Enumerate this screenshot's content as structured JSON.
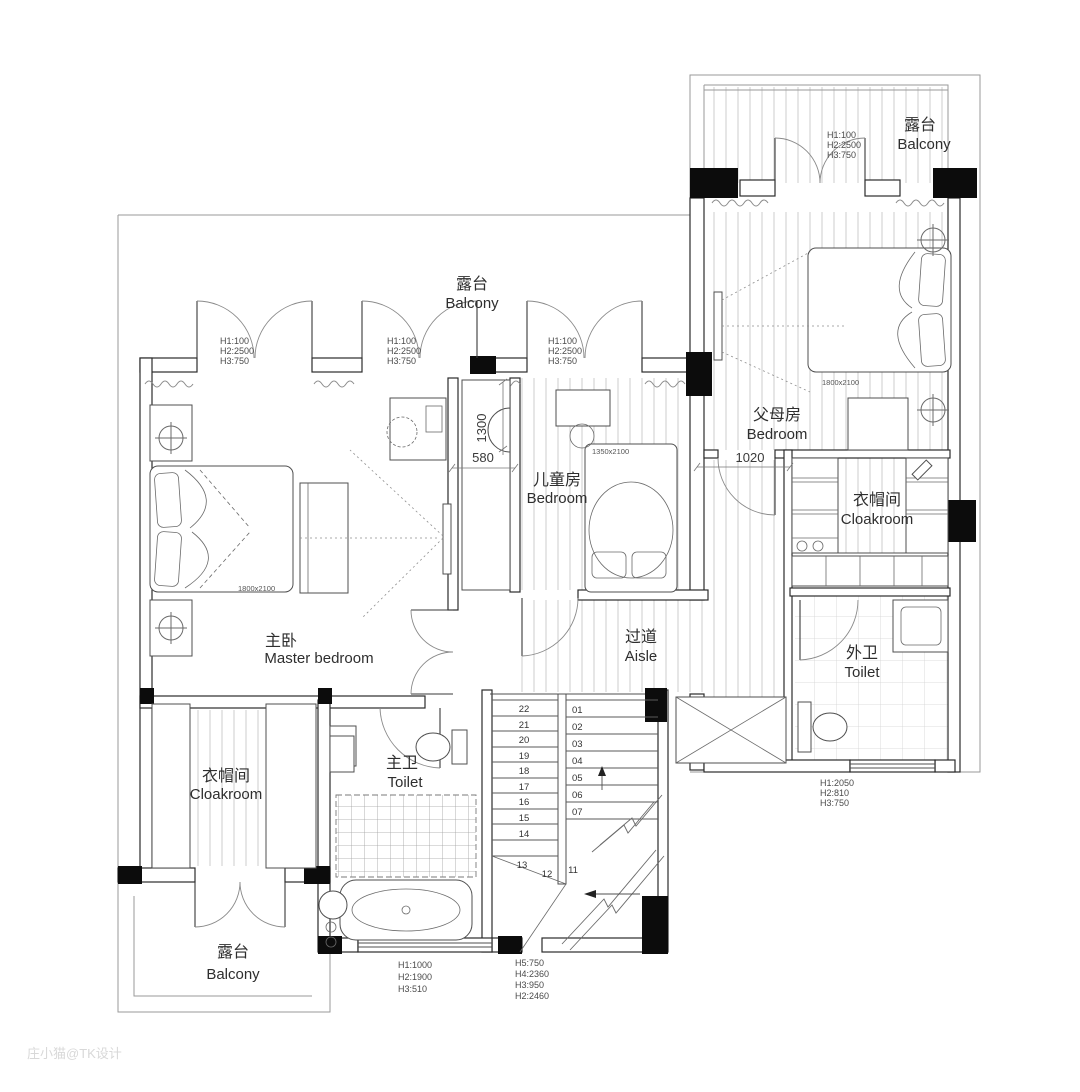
{
  "watermark": "庄小猫@TK设计",
  "colors": {
    "wall": "#2b2b2b",
    "pier": "#0c0c0c",
    "floor_hatch": "#c9c9c9",
    "boundary": "#9a9a9a",
    "watermark": "#d8d8d8"
  },
  "rooms": {
    "balcony_top_right": {
      "zh": "露台",
      "en": "Balcony"
    },
    "balcony_main": {
      "zh": "露台",
      "en": "Balcony"
    },
    "parents_bedroom": {
      "zh": "父母房",
      "en": "Bedroom"
    },
    "kids_bedroom": {
      "zh": "儿童房",
      "en": "Bedroom"
    },
    "cloakroom_right": {
      "zh": "衣帽间",
      "en": "Cloakroom"
    },
    "toilet_outer": {
      "zh": "外卫",
      "en": "Toilet"
    },
    "aisle": {
      "zh": "过道",
      "en": "Aisle"
    },
    "master_bedroom": {
      "zh": "主卧",
      "en": "Master bedroom"
    },
    "cloakroom_left": {
      "zh": "衣帽间",
      "en": "Cloakroom"
    },
    "toilet_master": {
      "zh": "主卫",
      "en": "Toilet"
    },
    "balcony_bottom": {
      "zh": "露台",
      "en": "Balcony"
    }
  },
  "beds": {
    "master": "1800x2100",
    "parents": "1800x2100",
    "kids": "1350x2100"
  },
  "dims": {
    "niche_depth": "1300",
    "niche_width": "580",
    "parents_dim": "1020"
  },
  "door_labels": {
    "balcony_door": {
      "l1": "H1:100",
      "l2": "H2:2500",
      "l3": "H3:750"
    },
    "outer_toilet_window": {
      "l1": "H1:2050",
      "l2": "H2:810",
      "l3": "H3:750"
    },
    "bath_window": {
      "l1": "H1:1000",
      "l2": "H2:1900",
      "l3": "H3:510"
    },
    "stair_window": {
      "l1": "H5:750",
      "l2": "H4:2360",
      "l3": "H3:950",
      "l4": "H2:2460"
    }
  },
  "stairs": {
    "upper_flight": [
      "22",
      "21",
      "20",
      "19",
      "18",
      "17",
      "16",
      "15",
      "14"
    ],
    "turn": [
      "13",
      "12",
      "11"
    ],
    "lower_flight": [
      "01",
      "02",
      "03",
      "04",
      "05",
      "06",
      "07"
    ]
  }
}
